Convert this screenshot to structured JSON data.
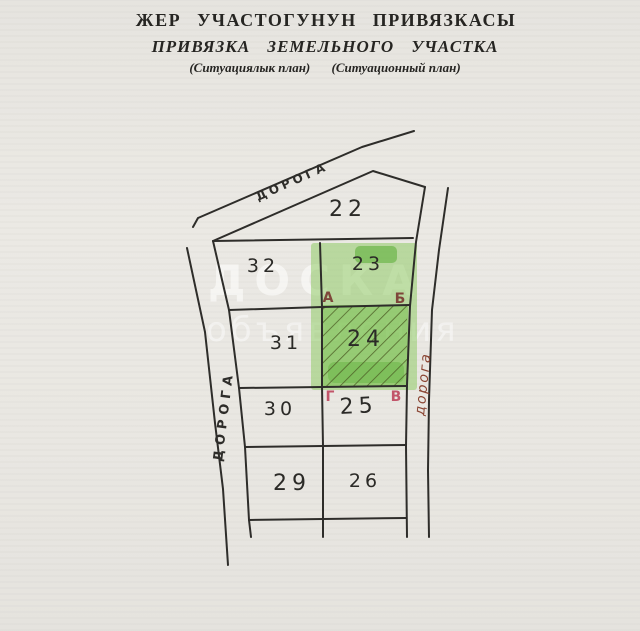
{
  "title": {
    "line1": "ЖЕР УЧАСТОГУНУН ПРИВЯЗКАСЫ",
    "line2": "ПРИВЯЗКА ЗЕМЕЛЬНОГО УЧАСТКА",
    "line3a": "(Ситуациялык план)",
    "line3b": "(Ситуационный план)"
  },
  "plan": {
    "roads": {
      "top": "ДОРОГА",
      "left": "ДОРОГА",
      "right": "дорога"
    },
    "plots": {
      "p22": "22",
      "p23": "23",
      "p24": "24",
      "p25": "25",
      "p26": "26",
      "p29": "29",
      "p30": "30",
      "p31": "31",
      "p32": "32"
    },
    "corners": {
      "a": "А",
      "b": "Б",
      "v": "В",
      "g": "Г"
    },
    "colors": {
      "highlight_green": "#8cc960",
      "highlight_dark_green": "#4ea827",
      "hatch": "#4a5a22",
      "ink": "#2e2d2a",
      "corner_letters_dark": "#7e463a",
      "corner_letters_red": "#c2556a",
      "road_label_right": "#8a4533"
    }
  },
  "watermark": {
    "line1": "ДОСКА",
    "line2": "объявления"
  }
}
